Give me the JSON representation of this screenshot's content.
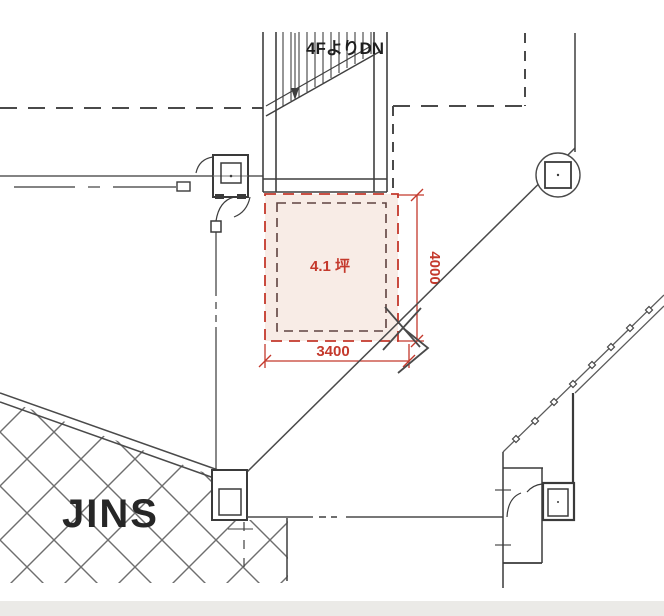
{
  "drawing": {
    "type": "architectural-floor-plan",
    "labels": {
      "stair_note": "4FよりDN",
      "lease_area": "4.1 坪",
      "width_mm": "3400",
      "depth_mm": "4000",
      "neighbor_tenant": "JINS"
    },
    "colors": {
      "dimension_red": "#c4392c",
      "lease_fill_pink": "#f8ece6",
      "inner_boundary_maroon": "#5f4340",
      "line_dark": "#3f3f3f",
      "hatch_gray": "#6e6e6e",
      "bottom_band_gray": "#ebeae7"
    }
  }
}
